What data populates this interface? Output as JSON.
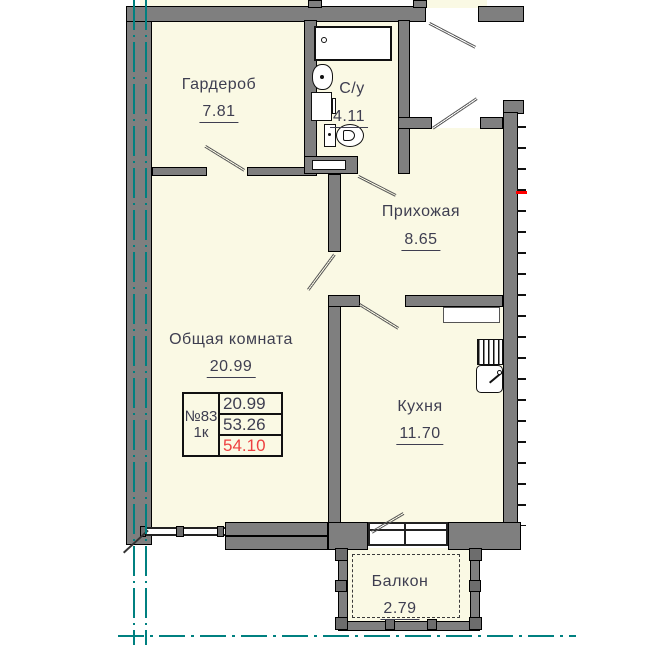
{
  "title": "Apartment floor plan",
  "rooms": [
    {
      "id": "wardrobe",
      "name": "Гардероб",
      "area": "7.81"
    },
    {
      "id": "bathroom",
      "name": "С/у",
      "area": "4.11"
    },
    {
      "id": "hallway",
      "name": "Прихожая",
      "area": "8.65"
    },
    {
      "id": "living",
      "name": "Общая комната",
      "area": "20.99"
    },
    {
      "id": "kitchen",
      "name": "Кухня",
      "area": "11.70"
    },
    {
      "id": "balcony",
      "name": "Балкон",
      "area": "2.79"
    }
  ],
  "info": {
    "number": "№83",
    "type": "1к",
    "living_area": "20.99",
    "area_without_balcony": "53.26",
    "total_area": "54.10"
  },
  "colors": {
    "floor": "#faf9e4",
    "wall": "#7f7f7f",
    "axis": "#008080",
    "total_highlight": "#ee4040",
    "section_mark": "#ff0000",
    "text": "#3e3e50"
  }
}
